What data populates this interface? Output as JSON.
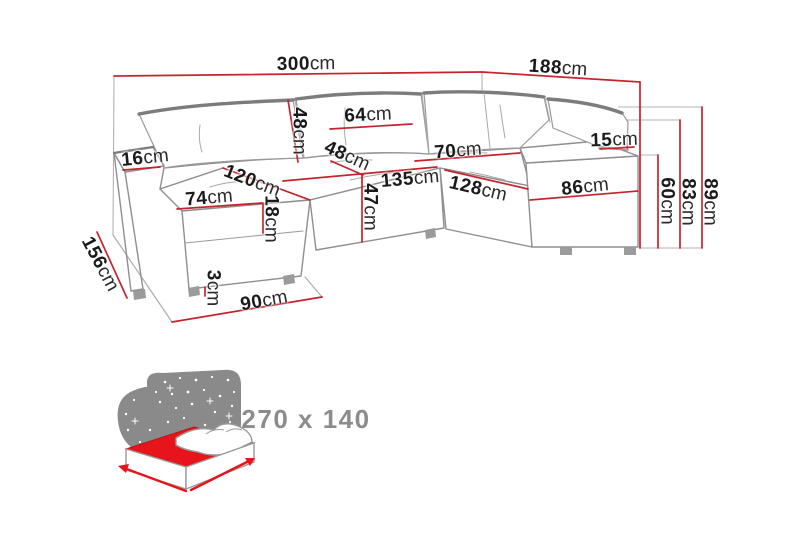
{
  "title": "Corner sofa dimension diagram",
  "colors": {
    "dimension_red": "#c5232d",
    "sofa_line_gray": "#8f8f8f",
    "icon_gray": "#8a8a8a",
    "mattress_red": "#e8141c"
  },
  "dimensions": {
    "total_width": {
      "value": "300",
      "unit": "cm"
    },
    "total_depth_right": {
      "value": "188",
      "unit": "cm"
    },
    "left_armrest_width": {
      "value": "16",
      "unit": "cm"
    },
    "back_cushion_height": {
      "value": "48",
      "unit": "cm"
    },
    "back_cushion_width": {
      "value": "64",
      "unit": "cm"
    },
    "corner_seat_depth": {
      "value": "48",
      "unit": "cm"
    },
    "right_seat_width": {
      "value": "70",
      "unit": "cm"
    },
    "main_seat_length": {
      "value": "135",
      "unit": "cm"
    },
    "right_seat_length": {
      "value": "128",
      "unit": "cm"
    },
    "seat_height": {
      "value": "47",
      "unit": "cm"
    },
    "chaise_seat_diagonal": {
      "value": "120",
      "unit": "cm"
    },
    "chaise_width": {
      "value": "74",
      "unit": "cm"
    },
    "chaise_side_height": {
      "value": "18",
      "unit": "cm"
    },
    "total_depth_left": {
      "value": "156",
      "unit": "cm"
    },
    "leg_height": {
      "value": "3",
      "unit": "cm"
    },
    "chaise_floor_length": {
      "value": "90",
      "unit": "cm"
    },
    "armrest_cushion_height": {
      "value": "15",
      "unit": "cm"
    },
    "right_panel_width": {
      "value": "86",
      "unit": "cm"
    },
    "armrest_height": {
      "value": "60",
      "unit": "cm"
    },
    "backrest_height": {
      "value": "83",
      "unit": "cm"
    },
    "total_height": {
      "value": "89",
      "unit": "cm"
    }
  },
  "sleeping_area": {
    "label": "270 x 140"
  }
}
